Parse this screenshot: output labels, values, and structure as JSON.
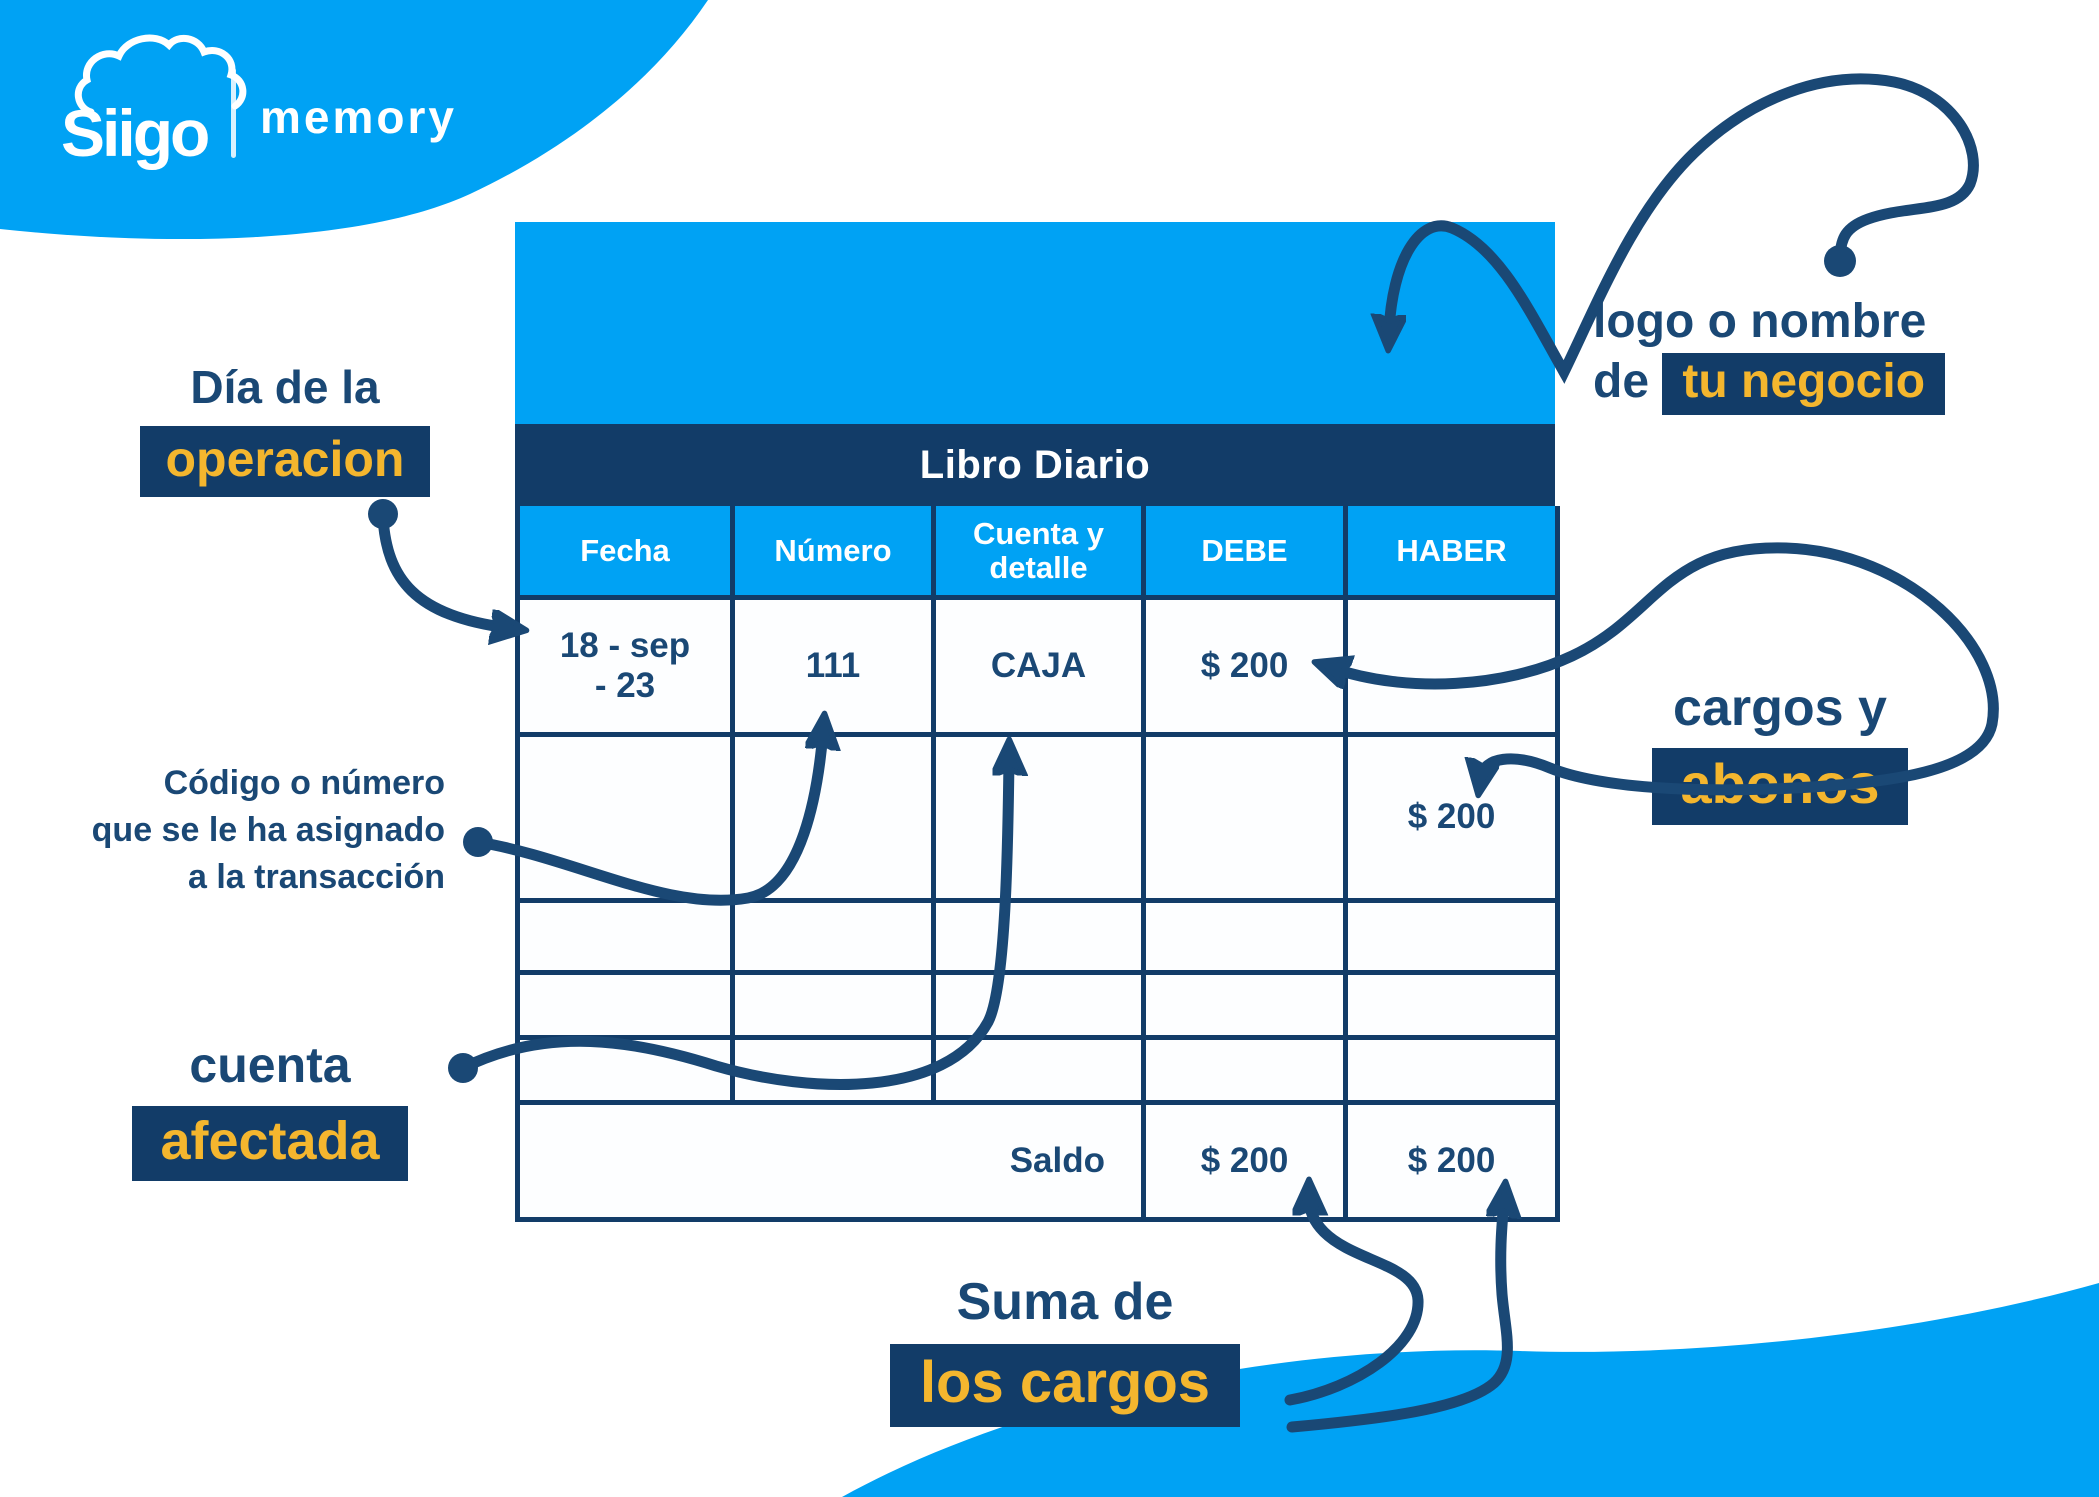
{
  "colors": {
    "accent_blue": "#00A2F4",
    "navy": "#1A4875",
    "navy_dark": "#123C68",
    "yellow": "#F4B62E",
    "white": "#FFFFFF"
  },
  "brand": {
    "name": "Siigo",
    "product": "memory"
  },
  "ledger": {
    "title": "Libro Diario",
    "columns": [
      "Fecha",
      "Número",
      "Cuenta y\ndetalle",
      "DEBE",
      "HABER"
    ],
    "rows": [
      {
        "fecha": "18 - sep\n- 23",
        "numero": "111",
        "cuenta": "CAJA",
        "debe": "$ 200",
        "haber": ""
      },
      {
        "fecha": "",
        "numero": "",
        "cuenta": "",
        "debe": "",
        "haber": "$ 200"
      },
      {
        "fecha": "",
        "numero": "",
        "cuenta": "",
        "debe": "",
        "haber": ""
      },
      {
        "fecha": "",
        "numero": "",
        "cuenta": "",
        "debe": "",
        "haber": ""
      },
      {
        "fecha": "",
        "numero": "",
        "cuenta": "",
        "debe": "",
        "haber": ""
      }
    ],
    "footer": {
      "label": "Saldo",
      "debe": "$ 200",
      "haber": "$ 200"
    }
  },
  "annotations": {
    "operation_day": {
      "text": "Día de la",
      "highlight": "operacion"
    },
    "transaction_code": {
      "line1": "Código o número",
      "line2_prefix": "que se le ha ",
      "line2_bold": "asignado",
      "line3": "a la transacción"
    },
    "affected_account": {
      "text": "cuenta",
      "highlight": "afectada"
    },
    "charges_credits": {
      "text": "cargos y",
      "highlight": "abonos"
    },
    "business_logo": {
      "line1": "logo o nombre",
      "line2_prefix": "de ",
      "highlight": "tu negocio"
    },
    "charges_sum": {
      "text": "Suma de",
      "highlight": "los cargos"
    }
  }
}
